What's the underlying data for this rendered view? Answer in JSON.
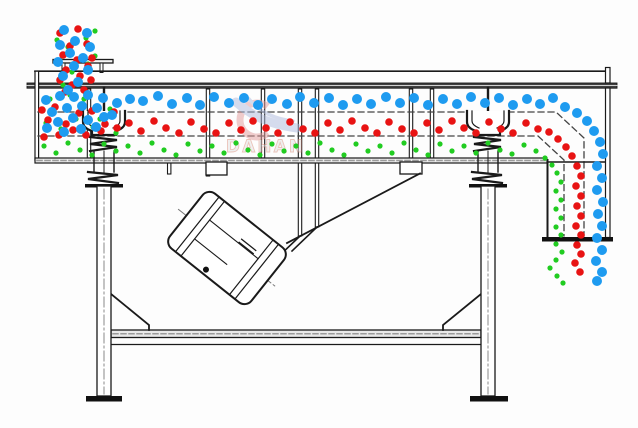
{
  "watermark": {
    "brand": "DAHAN",
    "registered_mark": "®"
  },
  "colors": {
    "blue_particle": "#1e9bf0",
    "red_particle": "#e81313",
    "green_particle": "#21cc21",
    "line": "#1a1a1a",
    "hatch_fill": "#ececec",
    "watermark_red": "#e39b9b",
    "watermark_blue": "#aebbdf",
    "watermark_text": "#e3e3e3"
  },
  "particles": {
    "green": {
      "r": 2.6,
      "color": "#21cc21",
      "points": [
        [
          95,
          31
        ],
        [
          57,
          40
        ],
        [
          86,
          38
        ],
        [
          68,
          47
        ],
        [
          95,
          56
        ],
        [
          60,
          60
        ],
        [
          88,
          64
        ],
        [
          72,
          72
        ],
        [
          92,
          80
        ],
        [
          63,
          85
        ],
        [
          85,
          92
        ],
        [
          70,
          95
        ],
        [
          50,
          99
        ],
        [
          84,
          99
        ],
        [
          110,
          109
        ],
        [
          46,
          123
        ],
        [
          76,
          119
        ],
        [
          100,
          119
        ],
        [
          61,
          129
        ],
        [
          93,
          127
        ],
        [
          116,
          133
        ],
        [
          44,
          146
        ],
        [
          56,
          153
        ],
        [
          68,
          143
        ],
        [
          80,
          150
        ],
        [
          92,
          155
        ],
        [
          104,
          144
        ],
        [
          116,
          151
        ],
        [
          128,
          146
        ],
        [
          140,
          153
        ],
        [
          152,
          143
        ],
        [
          164,
          150
        ],
        [
          176,
          155
        ],
        [
          188,
          144
        ],
        [
          200,
          151
        ],
        [
          212,
          146
        ],
        [
          224,
          153
        ],
        [
          236,
          143
        ],
        [
          248,
          150
        ],
        [
          260,
          155
        ],
        [
          272,
          144
        ],
        [
          284,
          151
        ],
        [
          296,
          146
        ],
        [
          308,
          153
        ],
        [
          320,
          143
        ],
        [
          332,
          150
        ],
        [
          344,
          155
        ],
        [
          356,
          144
        ],
        [
          368,
          151
        ],
        [
          380,
          146
        ],
        [
          392,
          153
        ],
        [
          404,
          143
        ],
        [
          416,
          150
        ],
        [
          428,
          155
        ],
        [
          440,
          144
        ],
        [
          452,
          151
        ],
        [
          464,
          146
        ],
        [
          476,
          153
        ],
        [
          488,
          143
        ],
        [
          500,
          150
        ],
        [
          512,
          154
        ],
        [
          524,
          145
        ],
        [
          536,
          151
        ],
        [
          545,
          158
        ],
        [
          552,
          165
        ],
        [
          557,
          173
        ],
        [
          561,
          182
        ],
        [
          556,
          191
        ],
        [
          561,
          200
        ],
        [
          556,
          209
        ],
        [
          561,
          218
        ],
        [
          556,
          227
        ],
        [
          561,
          235
        ],
        [
          556,
          244
        ],
        [
          562,
          252
        ],
        [
          556,
          260
        ],
        [
          550,
          268
        ],
        [
          557,
          276
        ],
        [
          563,
          283
        ]
      ]
    },
    "red": {
      "r": 3.8,
      "color": "#e81313",
      "points": [
        [
          78,
          29
        ],
        [
          60,
          33
        ],
        [
          87,
          44
        ],
        [
          70,
          46
        ],
        [
          92,
          58
        ],
        [
          63,
          55
        ],
        [
          77,
          60
        ],
        [
          88,
          66
        ],
        [
          66,
          70
        ],
        [
          80,
          76
        ],
        [
          91,
          80
        ],
        [
          60,
          80
        ],
        [
          72,
          85
        ],
        [
          84,
          90
        ],
        [
          65,
          92
        ],
        [
          42,
          110
        ],
        [
          55,
          107
        ],
        [
          48,
          120
        ],
        [
          66,
          124
        ],
        [
          79,
          113
        ],
        [
          92,
          111
        ],
        [
          105,
          124
        ],
        [
          114,
          112
        ],
        [
          59,
          135
        ],
        [
          73,
          130
        ],
        [
          86,
          135
        ],
        [
          101,
          131
        ],
        [
          44,
          137
        ],
        [
          117,
          128
        ],
        [
          129,
          123
        ],
        [
          141,
          131
        ],
        [
          154,
          121
        ],
        [
          166,
          128
        ],
        [
          179,
          133
        ],
        [
          191,
          122
        ],
        [
          204,
          129
        ],
        [
          216,
          133
        ],
        [
          229,
          123
        ],
        [
          241,
          130
        ],
        [
          253,
          121
        ],
        [
          266,
          128
        ],
        [
          278,
          133
        ],
        [
          290,
          122
        ],
        [
          303,
          129
        ],
        [
          315,
          133
        ],
        [
          328,
          123
        ],
        [
          340,
          130
        ],
        [
          352,
          121
        ],
        [
          365,
          128
        ],
        [
          377,
          133
        ],
        [
          389,
          122
        ],
        [
          402,
          129
        ],
        [
          414,
          133
        ],
        [
          427,
          123
        ],
        [
          439,
          130
        ],
        [
          452,
          121
        ],
        [
          464,
          128
        ],
        [
          476,
          133
        ],
        [
          489,
          122
        ],
        [
          501,
          129
        ],
        [
          513,
          133
        ],
        [
          526,
          123
        ],
        [
          538,
          129
        ],
        [
          549,
          132
        ],
        [
          558,
          139
        ],
        [
          566,
          147
        ],
        [
          572,
          156
        ],
        [
          577,
          166
        ],
        [
          581,
          176
        ],
        [
          576,
          186
        ],
        [
          581,
          196
        ],
        [
          577,
          206
        ],
        [
          581,
          216
        ],
        [
          576,
          226
        ],
        [
          581,
          235
        ],
        [
          577,
          245
        ],
        [
          581,
          254
        ],
        [
          575,
          263
        ],
        [
          580,
          272
        ]
      ]
    },
    "blue": {
      "r": 5,
      "color": "#1e9bf0",
      "points": [
        [
          64,
          30
        ],
        [
          87,
          33
        ],
        [
          75,
          41
        ],
        [
          60,
          45
        ],
        [
          90,
          47
        ],
        [
          70,
          53
        ],
        [
          83,
          58
        ],
        [
          58,
          62
        ],
        [
          74,
          66
        ],
        [
          88,
          70
        ],
        [
          63,
          76
        ],
        [
          78,
          82
        ],
        [
          68,
          90
        ],
        [
          46,
          100
        ],
        [
          60,
          96
        ],
        [
          74,
          97
        ],
        [
          88,
          95
        ],
        [
          103,
          98
        ],
        [
          117,
          103
        ],
        [
          130,
          99
        ],
        [
          52,
          112
        ],
        [
          67,
          108
        ],
        [
          82,
          106
        ],
        [
          97,
          108
        ],
        [
          112,
          115
        ],
        [
          58,
          122
        ],
        [
          73,
          118
        ],
        [
          88,
          120
        ],
        [
          104,
          117
        ],
        [
          47,
          128
        ],
        [
          64,
          132
        ],
        [
          81,
          129
        ],
        [
          96,
          127
        ],
        [
          143,
          101
        ],
        [
          158,
          96
        ],
        [
          172,
          104
        ],
        [
          187,
          98
        ],
        [
          200,
          105
        ],
        [
          214,
          97
        ],
        [
          229,
          103
        ],
        [
          244,
          98
        ],
        [
          258,
          105
        ],
        [
          272,
          99
        ],
        [
          287,
          104
        ],
        [
          300,
          97
        ],
        [
          314,
          103
        ],
        [
          329,
          98
        ],
        [
          343,
          105
        ],
        [
          357,
          99
        ],
        [
          371,
          104
        ],
        [
          386,
          97
        ],
        [
          400,
          103
        ],
        [
          414,
          98
        ],
        [
          428,
          105
        ],
        [
          443,
          99
        ],
        [
          457,
          104
        ],
        [
          471,
          97
        ],
        [
          485,
          103
        ],
        [
          499,
          98
        ],
        [
          513,
          105
        ],
        [
          527,
          99
        ],
        [
          540,
          104
        ],
        [
          553,
          98
        ],
        [
          565,
          107
        ],
        [
          577,
          113
        ],
        [
          587,
          121
        ],
        [
          594,
          131
        ],
        [
          600,
          142
        ],
        [
          603,
          154
        ],
        [
          597,
          166
        ],
        [
          602,
          178
        ],
        [
          597,
          190
        ],
        [
          603,
          202
        ],
        [
          598,
          214
        ],
        [
          602,
          226
        ],
        [
          597,
          238
        ],
        [
          602,
          250
        ],
        [
          596,
          261
        ],
        [
          602,
          272
        ],
        [
          597,
          281
        ]
      ]
    }
  }
}
